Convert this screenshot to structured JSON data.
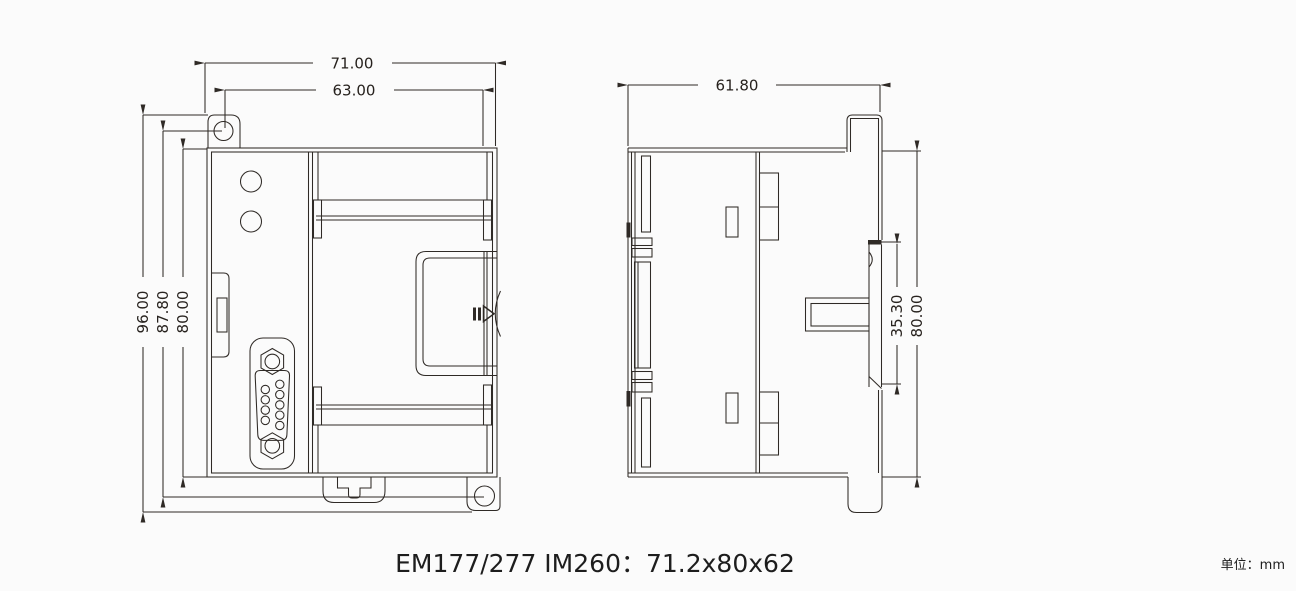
{
  "caption": {
    "text": "EM177/277 IM260：71.2x80x62"
  },
  "unit_note": {
    "text": "单位：mm"
  },
  "front_view": {
    "dims": {
      "overall_width": "71.00",
      "inner_width": "63.00",
      "overall_height": "96.00",
      "hole_pitch_height": "87.80",
      "body_height": "80.00"
    }
  },
  "side_view": {
    "dims": {
      "overall_depth": "61.80",
      "latch_height": "35.30",
      "body_height": "80.00"
    }
  },
  "colors": {
    "ink": "#2f2a26",
    "background": "#fbfbfb"
  }
}
